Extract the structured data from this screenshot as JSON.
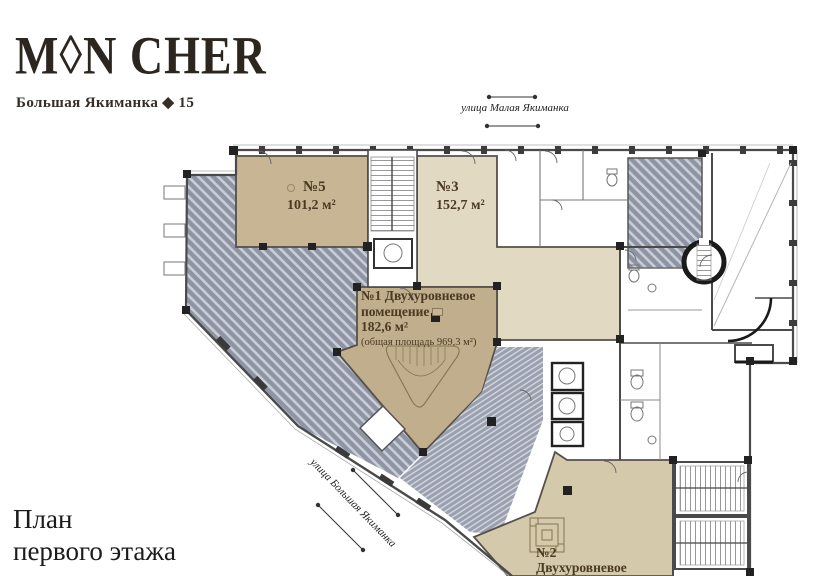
{
  "brand": {
    "logo": "M◊N CHER",
    "address": "Большая Якиманка ◆ 15"
  },
  "title": {
    "line1": "План",
    "line2": "первого этажа"
  },
  "streets": {
    "top": "улица Малая Якиманка",
    "diagonal": "улица Большая Якиманка"
  },
  "units": {
    "u5": {
      "number": "№5",
      "area": "101,2 м²"
    },
    "u3": {
      "number": "№3",
      "area": "152,7 м²"
    },
    "u1": {
      "line1": "№1 Двухуровневое",
      "line2": "помещение",
      "area": "182,6 м²",
      "total": "(общая площадь 969,3 м²)"
    },
    "u2": {
      "number": "№2",
      "type": "Двухуровневое"
    }
  },
  "icons": {
    "unit5_marker": "small-circle-marker",
    "unit1_legend": "beige-area-swatch"
  },
  "colors": {
    "unit5": "#c7b593",
    "unit3": "#e2d9c2",
    "unit1": "#c0ae8c",
    "unit2": "#d5c9ab",
    "hatch": "#8e94a3",
    "hatchLine": "#c9cdd6",
    "ramp": "#9aa0af",
    "rampLine": "#d4d7dd",
    "wall": "#55504a",
    "ink": "#2c2620",
    "label": "#4a3a22"
  }
}
